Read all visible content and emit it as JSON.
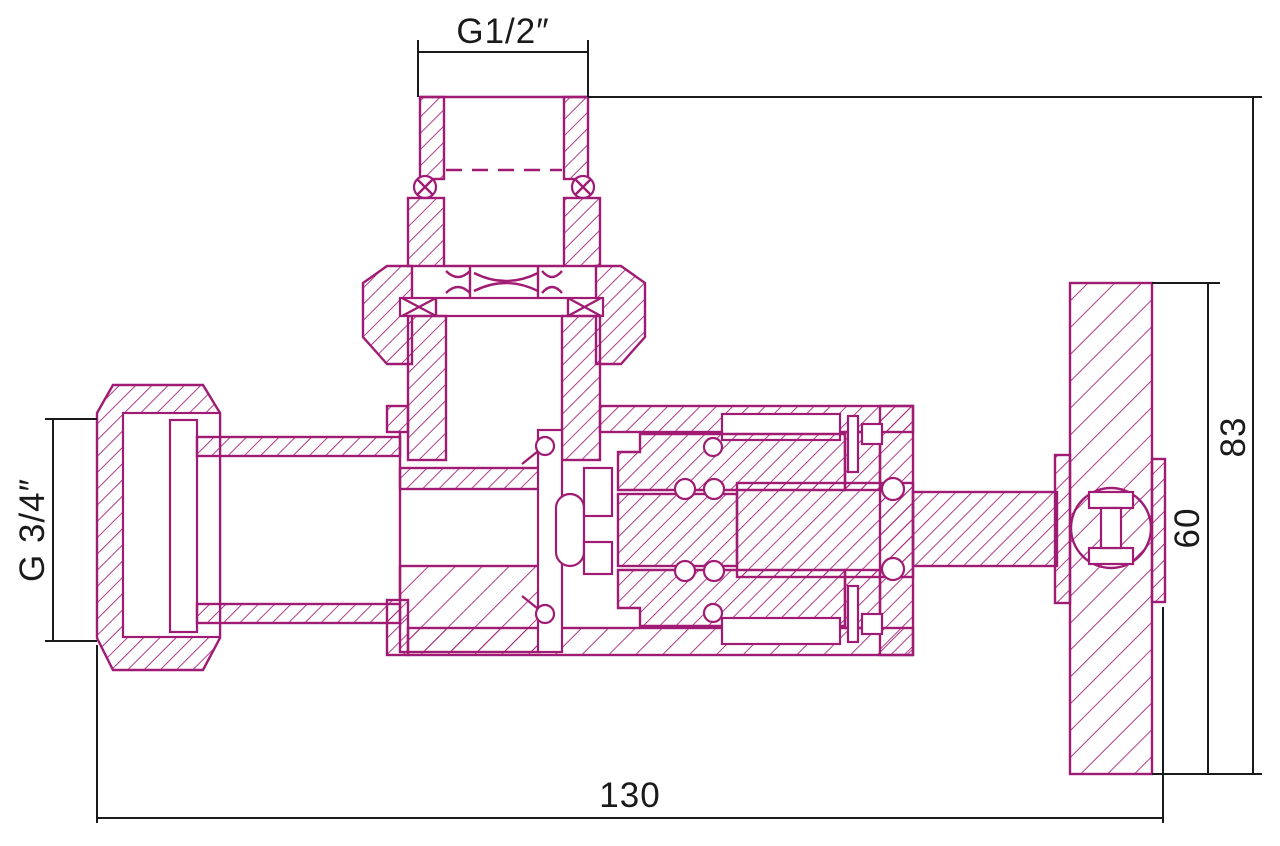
{
  "drawing": {
    "subject": "angle valve cross-section technical drawing",
    "colors": {
      "part_line": "#A01B73",
      "dimension_line": "#1a1a1a",
      "background": "#ffffff"
    },
    "labels": {
      "top_thread": "G1/2″",
      "left_thread": "G 3/4″",
      "height_overall": "83",
      "handle_diameter": "60",
      "length_overall": "130"
    }
  }
}
